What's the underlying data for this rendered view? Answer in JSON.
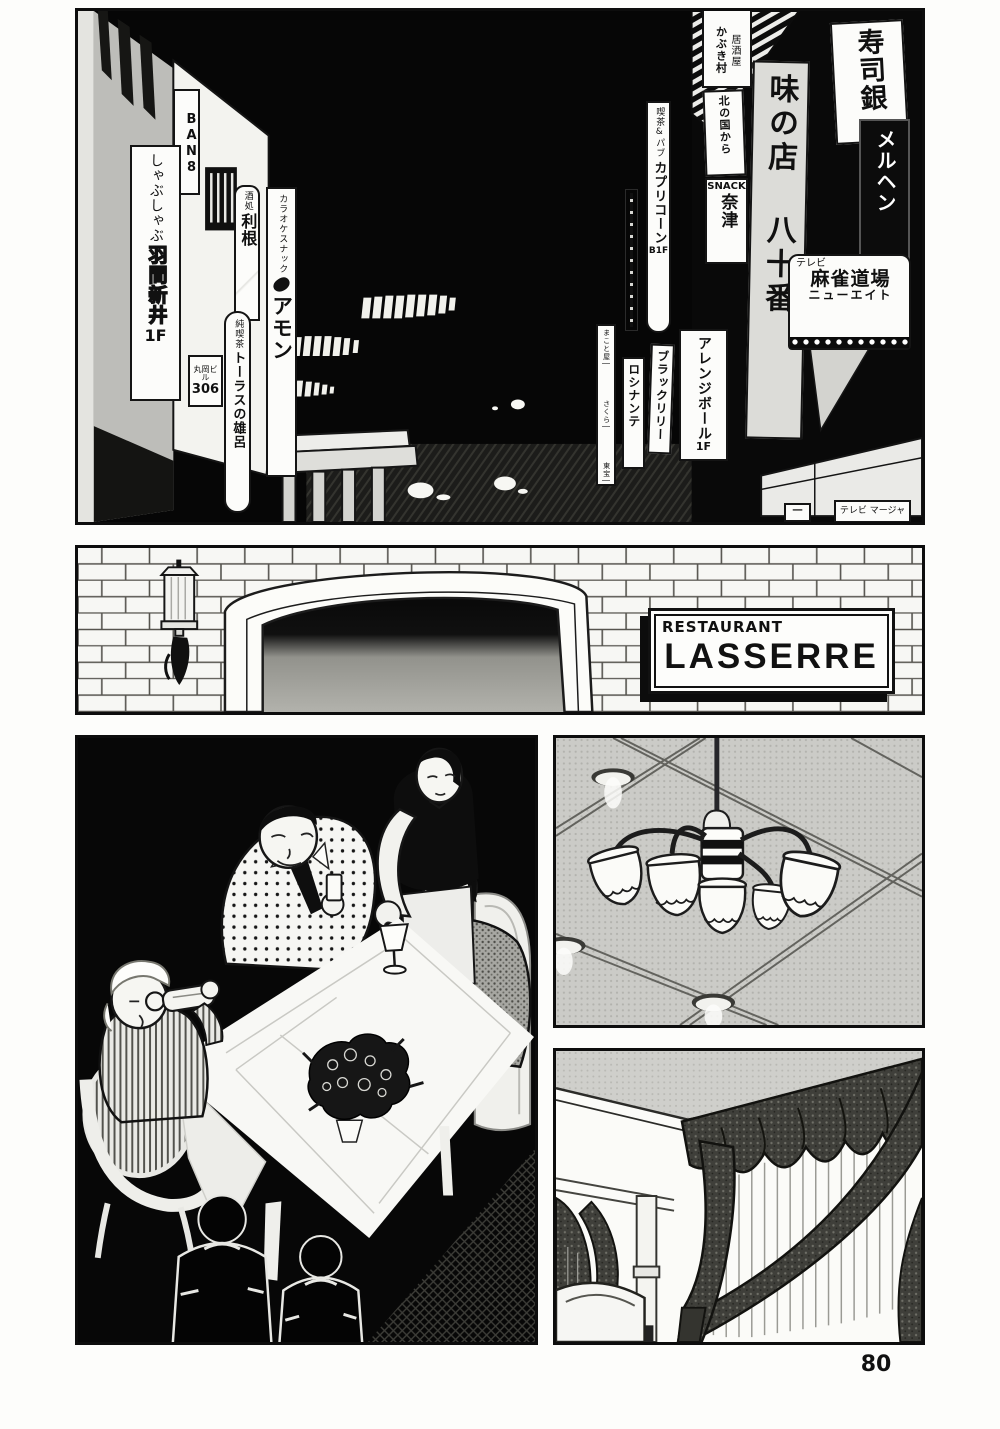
{
  "page": {
    "number": "80"
  },
  "top_panel": {
    "signs": {
      "ban8": {
        "text": "BAN8"
      },
      "shabu": {
        "top": "しゃぶしゃぶ",
        "name": "羽間新井",
        "floor": "1F"
      },
      "tone": {
        "header": "酒処",
        "text": "利根"
      },
      "taurus": {
        "header": "純喫茶",
        "text": "トーラスの雄呂"
      },
      "biru306": {
        "text": "丸岡ビル",
        "number": "306"
      },
      "amon": {
        "header": "カラオケスナック",
        "text": "アモン"
      },
      "capricorn": {
        "header": "喫茶&パブ",
        "text": "カプリコーン",
        "floor": "B1F"
      },
      "rocinante": {
        "text": "ロシナンテ"
      },
      "black_lily": {
        "text": "ブラックリリー"
      },
      "arrange_ball": {
        "text": "アレンジボール",
        "floor": "1F"
      },
      "makotoya": {
        "line1": "まこと屋",
        "line2": "さくら",
        "line3": "東宝"
      },
      "kabukimura": {
        "header": "居酒屋",
        "text": "かぶき村"
      },
      "kitanokuni": {
        "text": "北の国から"
      },
      "snack_natsu": {
        "header": "SNACK",
        "text": "奈津"
      },
      "ajinomise": {
        "text": "味の店 八十番"
      },
      "sushigin": {
        "text": "寿司銀"
      },
      "meruhen": {
        "text": "メルヘン"
      },
      "mahjong_dojo": {
        "header": "テレビ",
        "title": "麻雀道場",
        "sub": "ニューエイト"
      },
      "tv_mahjan": {
        "text": "テレビ マージャ"
      },
      "dash_box": {
        "text": "一"
      }
    }
  },
  "middle_panel": {
    "restaurant_sign": {
      "line1": "RESTAURANT",
      "line2": "LASSERRE"
    }
  }
}
